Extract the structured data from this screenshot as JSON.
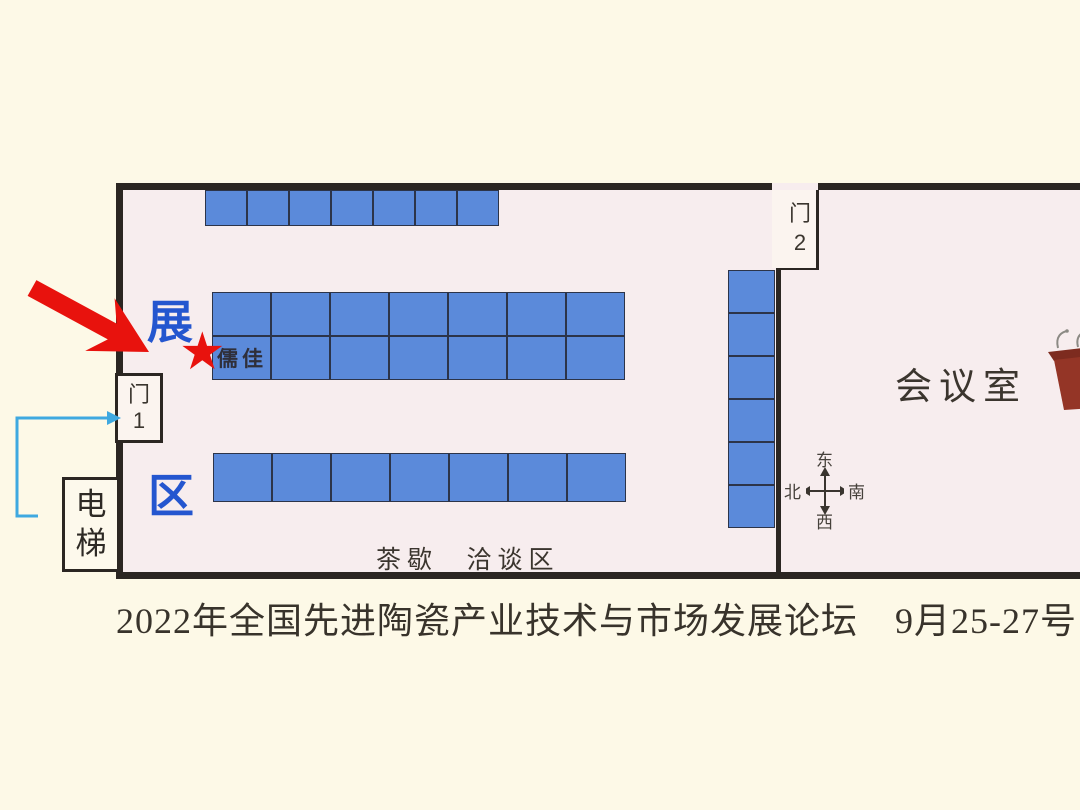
{
  "caption": {
    "text": "2022年全国先进陶瓷产业技术与市场发展论坛　9月25-27号·广"
  },
  "floor_plan": {
    "labels": {
      "zone_char_top": "展",
      "zone_char_bottom": "区",
      "booth_highlight": "儒佳",
      "meeting_room": "会议室",
      "tea_break": "茶歇",
      "negotiation_area": "洽谈区",
      "elevator": "电梯",
      "door1_char": "门",
      "door1_num": "1",
      "door2_char": "门",
      "door2_num": "2"
    },
    "compass": {
      "top": "东",
      "right": "南",
      "bottom": "西",
      "left": "北"
    },
    "icons": {
      "star": "★"
    },
    "booth_groups": [
      {
        "name": "top-row",
        "x": 205,
        "y": 190,
        "cols": 7,
        "rows": 1,
        "cell_w": 42,
        "cell_h": 36
      },
      {
        "name": "middle-block",
        "x": 212,
        "y": 292,
        "cols": 7,
        "rows": 2,
        "cell_w": 59,
        "cell_h": 44
      },
      {
        "name": "bottom-row",
        "x": 213,
        "y": 453,
        "cols": 7,
        "rows": 1,
        "cell_w": 59,
        "cell_h": 49
      },
      {
        "name": "side-column",
        "x": 728,
        "y": 270,
        "cols": 1,
        "rows": 6,
        "cell_w": 47,
        "cell_h": 43
      }
    ],
    "colors": {
      "booth_fill": "#5b8ada",
      "booth_border": "#2c3449",
      "wall": "#2b2622",
      "interior": "#f7edee",
      "exterior": "#fdf9e7",
      "accent_red": "#e8120d",
      "accent_blue": "#2456cf",
      "path_arrow_blue": "#3fa9e0",
      "podium_body": "#943526"
    }
  }
}
